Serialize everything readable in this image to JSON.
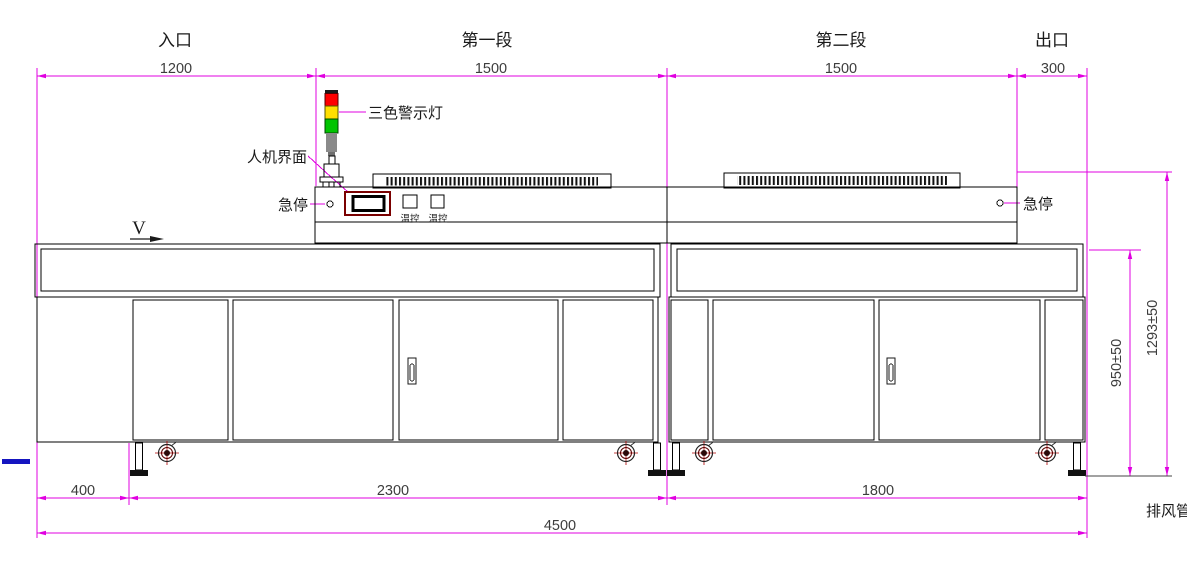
{
  "drawing": {
    "type": "equipment-side-elevation",
    "top_sections": [
      {
        "label": "入口",
        "dim": "1200"
      },
      {
        "label": "第一段",
        "dim": "1500"
      },
      {
        "label": "第二段",
        "dim": "1500"
      },
      {
        "label": "出口",
        "dim": "300"
      }
    ],
    "annotations": {
      "warning_light": "三色警示灯",
      "hmi": "人机界面",
      "estop_left": "急停",
      "estop_right": "急停",
      "temp_ctrl_left": "温控",
      "temp_ctrl_right": "温控",
      "speed_symbol": "V",
      "exhaust_duct": "排风管"
    },
    "bottom_dims": {
      "left_offset": "400",
      "module_a": "2300",
      "module_b": "1800",
      "total_length": "4500"
    },
    "height_dims": {
      "table_height": "950±50",
      "overall_height": "1293±50"
    },
    "colors": {
      "dimension": "#e000e0",
      "outline": "#000000",
      "light_red": "#ff0000",
      "light_yellow": "#ffdf00",
      "light_green": "#00c400",
      "light_pole": "#8a8a8a",
      "light_cap": "#1a1a1a",
      "screen_border": "#7a0000",
      "caster_red": "#b00000",
      "blue_mark": "#1515c0"
    }
  }
}
